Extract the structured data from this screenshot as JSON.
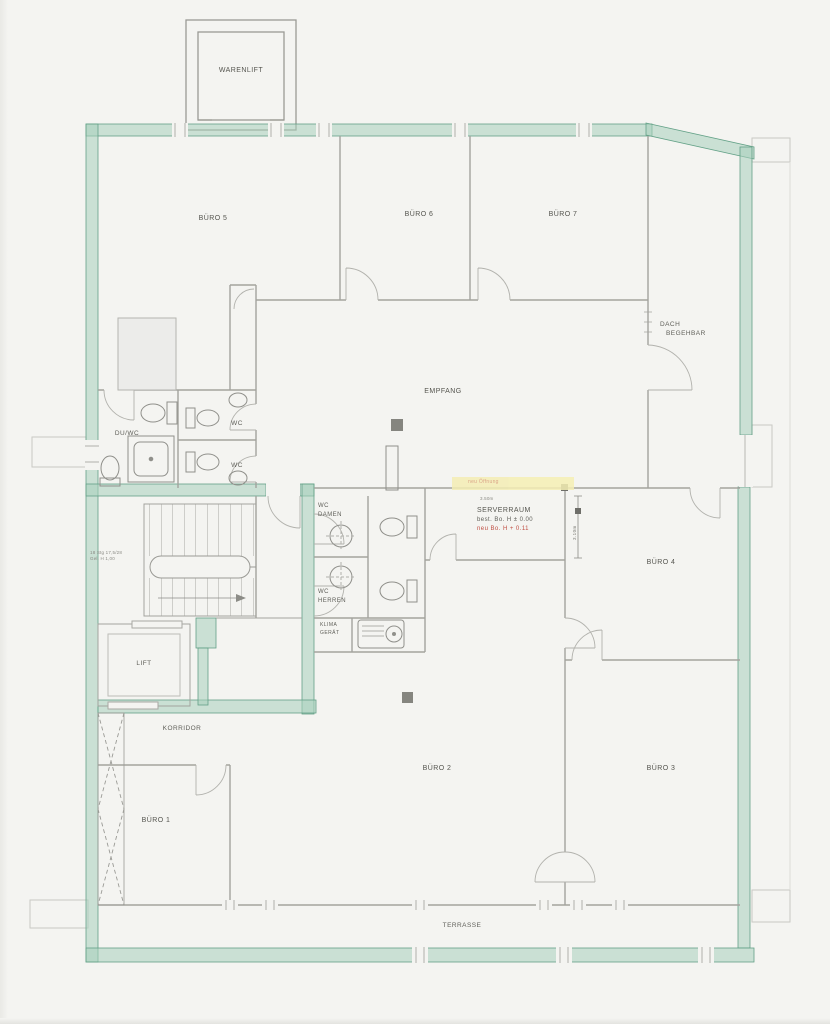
{
  "rooms": {
    "warenlift": "WARENLIFT",
    "buero5": "BÜRO 5",
    "buero6": "BÜRO 6",
    "buero7": "BÜRO 7",
    "dach_line1": "DACH",
    "dach_line2": "BEGEHBAR",
    "empfang": "EMPFANG",
    "du_wc": "DU/WC",
    "wc_top": "WC",
    "wc_bottom": "WC",
    "wc_damen_line1": "WC",
    "wc_damen_line2": "DAMEN",
    "wc_herren_line1": "WC",
    "wc_herren_line2": "HERREN",
    "klima_line1": "KLIMA",
    "klima_line2": "GERÄT",
    "serverraum": "SERVERRAUM",
    "lift": "LIFT",
    "korridor": "KORRIDOR",
    "buero1": "BÜRO 1",
    "buero2": "BÜRO 2",
    "buero3": "BÜRO 3",
    "buero4": "BÜRO 4",
    "terrasse": "TERRASSE"
  },
  "annotations": {
    "server_existing": "best. Bo. H ± 0.00",
    "server_new": "neu Bo. H + 0.11",
    "dim_width": "3.50m",
    "dim_height": "3.10m",
    "stair_note_line1": "18 Stg 17,5/28",
    "stair_note_line2": "Gel. H 1,00",
    "highlight_note": "neu Öffnung"
  },
  "colors": {
    "wall_highlight_green": "#63a187",
    "wall_fill_green": "#a8cfbc",
    "annotation_red": "#c05045",
    "highlight_yellow": "#f4eeb4",
    "line_gray": "#a3a39e"
  }
}
